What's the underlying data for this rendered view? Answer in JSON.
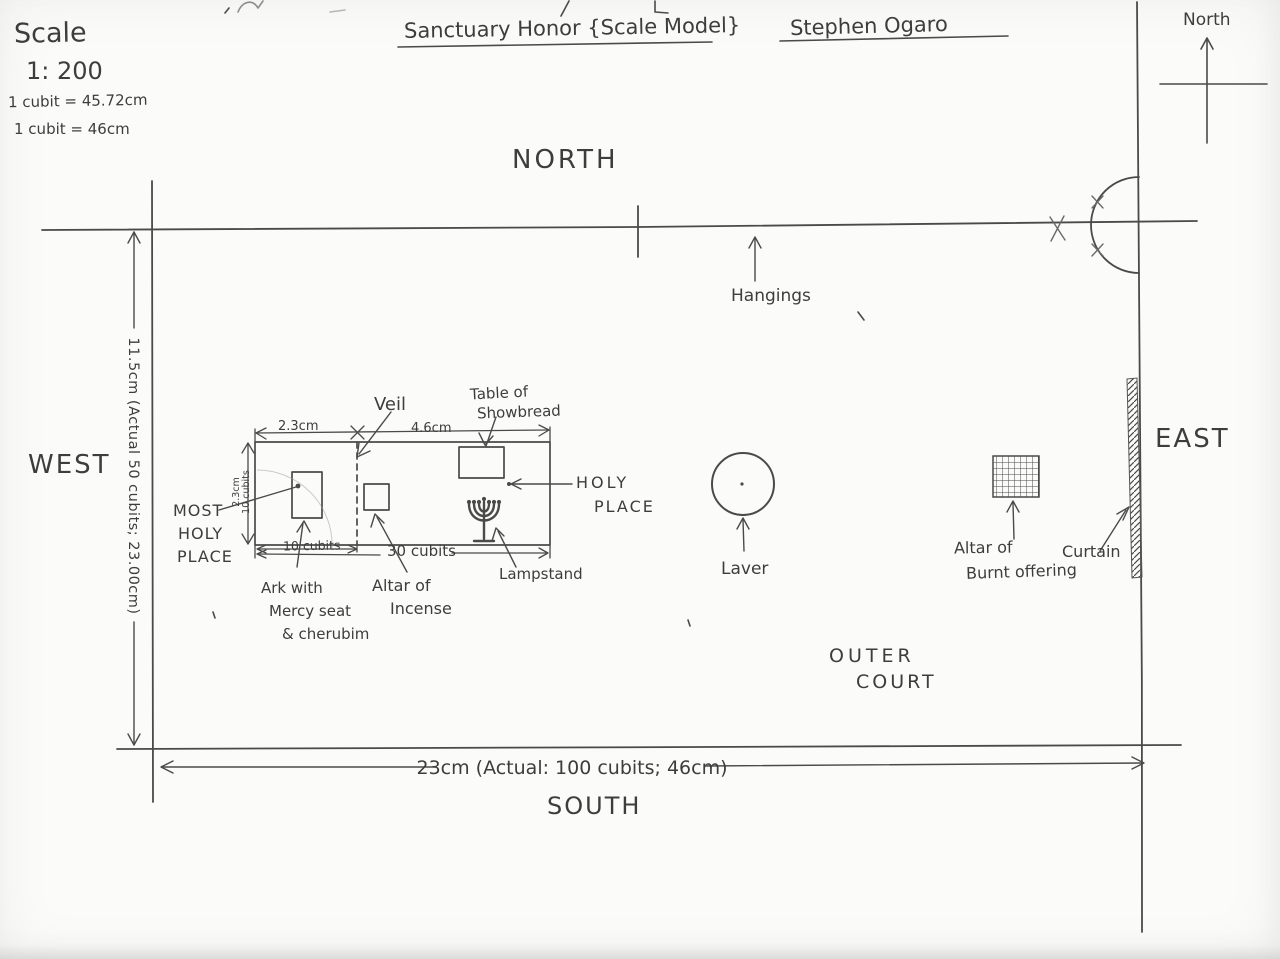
{
  "scale_block": {
    "heading": "Scale",
    "ratio": "1: 200",
    "cubit_line1": "1 cubit = 45.72cm",
    "cubit_line2": "1 cubit = 46cm"
  },
  "header": {
    "title": "Sanctuary Honor {Scale Model}",
    "author": "Stephen Ogaro"
  },
  "compass": {
    "label": "North"
  },
  "directions": {
    "north": "NORTH",
    "south": "SOUTH",
    "east": "EAST",
    "west": "WEST"
  },
  "outer_court": {
    "line1": "OUTER",
    "line2": "COURT"
  },
  "dimensions": {
    "west": "11.5cm (Actual 50 cubits; 23.00cm)",
    "south": "23cm (Actual: 100 cubits; 46cm)",
    "most_holy_width": "2.3cm",
    "holy_width": "4.6cm",
    "height_line1": "2.3cm",
    "height_line2": "10 cubits",
    "most_holy_length": "10 cubits",
    "sanctuary_length": "30 cubits"
  },
  "features": {
    "veil": "Veil",
    "table_of_showbread": [
      "Table of",
      "Showbread"
    ],
    "most_holy_place": [
      "MOST",
      "HOLY",
      "PLACE"
    ],
    "holy_place": [
      "HOLY",
      "PLACE"
    ],
    "ark": [
      "Ark with",
      "Mercy seat",
      "& cherubim"
    ],
    "altar_of_incense": [
      "Altar of",
      "Incense"
    ],
    "lampstand": "Lampstand",
    "hangings": "Hangings",
    "laver": "Laver",
    "altar_of_burnt_offering": [
      "Altar of",
      "Burnt offering"
    ],
    "curtain": "Curtain"
  },
  "colors": {
    "ink": "#3d3d3d",
    "paper": "#fbfbf9"
  }
}
